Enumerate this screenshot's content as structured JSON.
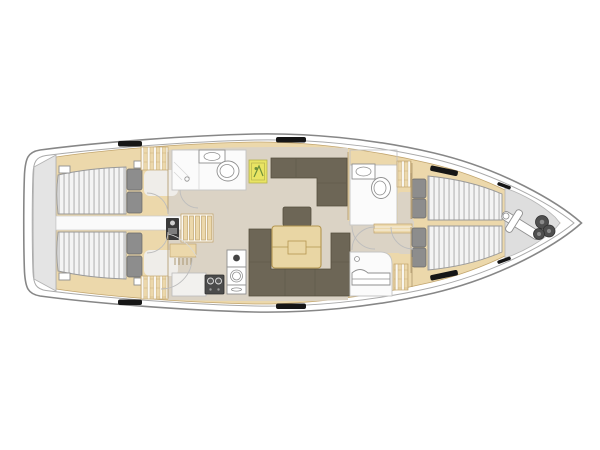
{
  "colors": {
    "hull-outline": "#878787",
    "inner-line": "#a9a9a9",
    "deck": "#ffffff",
    "platform": "#e4e4e4",
    "platform-line": "#b3b3b3",
    "wood": "#ecd8ab",
    "wood-line": "#c2a56e",
    "floor": "#dbd3c5",
    "cabin-floor": "#efede9",
    "strip": "#fafafa",
    "strip-line": "#c9c9c9",
    "mattress": "#f4f4f4",
    "mattress-stripe": "#bfbfbf",
    "mattress-line": "#999999",
    "pillow": "#8d8d8d",
    "pillow-line": "#6a6a6a",
    "slat-bg": "#faf8f2",
    "sofa": "#6d6656",
    "sofa-line": "#554f3e",
    "table": "#e9d6a4",
    "table-line": "#b3954f",
    "bath": "#fbfbfb",
    "bath-line": "#c4c4c4",
    "fixture": "#ffffff",
    "fixture-line": "#8f8f8f",
    "divider": "#d8d8d8",
    "stove": "#4b4b4b",
    "stove-line": "#2f2f2f",
    "burner": "#e0e0e0",
    "instrument": "#3a3a3a",
    "tv": "#e9e463",
    "tv-line": "#b6b34e",
    "tv-glyph": "#6c8f3a",
    "anchor-bg": "#dedede",
    "anchor-line": "#b5b5b5",
    "chain": "#4f4f4f",
    "chain-line": "#303030",
    "hatch": "#161616",
    "door": "#bdbdbd",
    "wall": "#b29a6e"
  },
  "labels": {
    "plan": "sailing yacht interior deck plan, bow to the right",
    "hull": "hull outline with side deck",
    "swim_platform": "stern swim platform",
    "aft_cabin_port": "port aft double cabin",
    "aft_cabin_starboard": "starboard aft double cabin",
    "engine_strip": "centerline engine compartment between aft cabins",
    "aft_head": "aft head with shower, sink and toilet",
    "companionway": "companionway steps",
    "nav_station": "navigation station with instrument panel",
    "galley": "galley with stove, double sink and counters",
    "tv_panel": "bulkhead panel / TV",
    "salon": "salon with U-shaped sofa, bench and folding table",
    "salon_table": "salon folding table",
    "fwd_head": "forward head with sink and toilet",
    "shower_room": "separate shower compartment with seat",
    "owner_cabin": "forward owner cabin with twin V-berths",
    "anchor_locker": "bow anchor locker with anchor and chain"
  }
}
